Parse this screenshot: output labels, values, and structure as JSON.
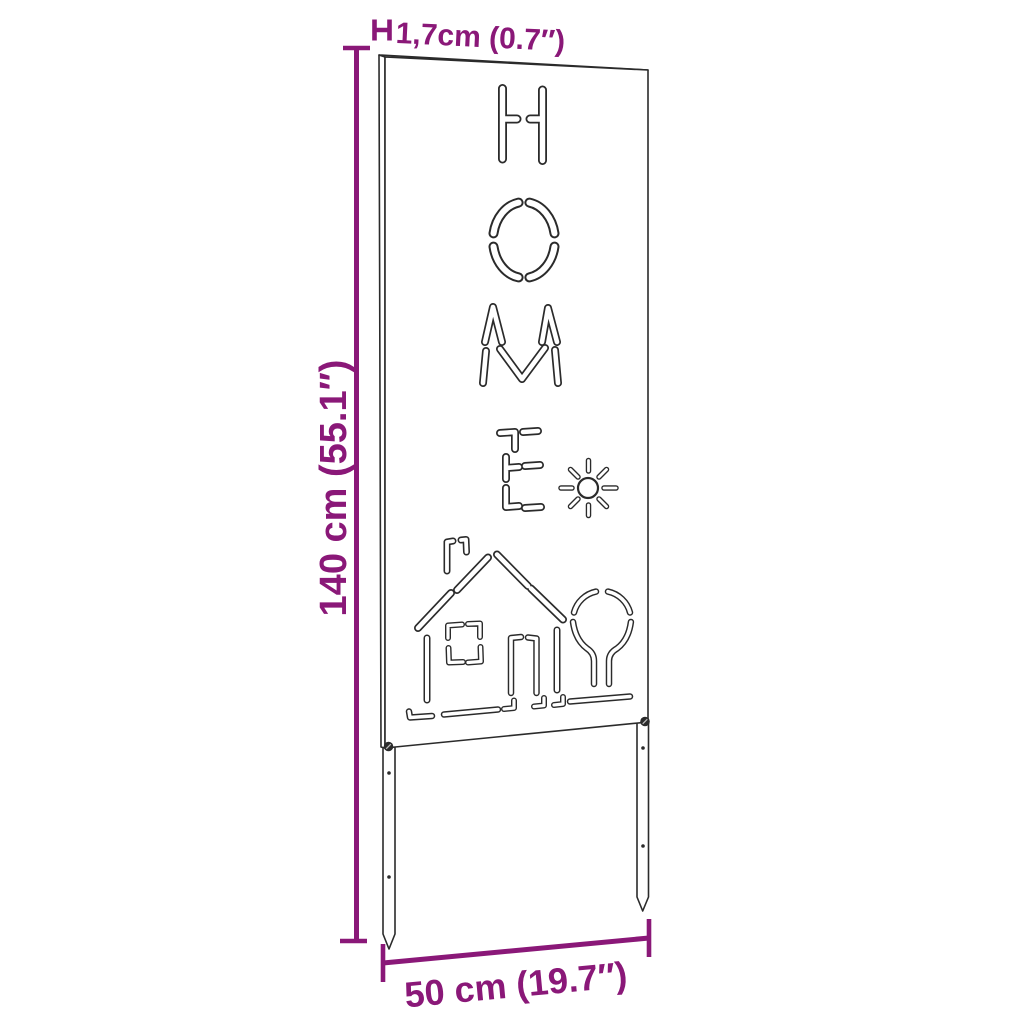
{
  "diagram": {
    "background_color": "#ffffff",
    "line_color": "#2b2b2b",
    "accent_color": "#8a1878",
    "panel": {
      "cutout_word": "HOME",
      "cutout_motifs": [
        "sun",
        "house",
        "tree"
      ],
      "stake_count": 2
    },
    "dimensions": {
      "thickness_label": "1,7cm (0.7″)",
      "height_label": "140 cm (55.1″)",
      "width_label": "50 cm (19.7″)"
    }
  }
}
